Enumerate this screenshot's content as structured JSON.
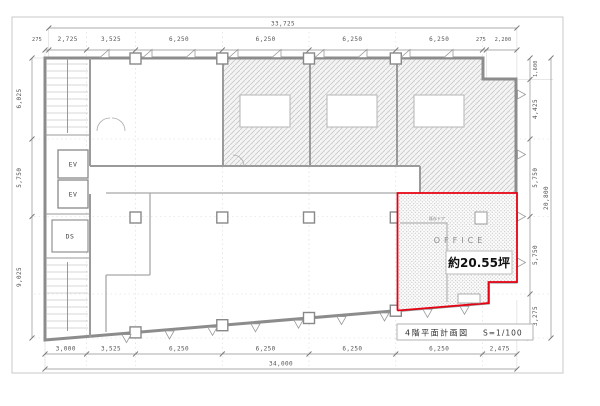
{
  "drawing": {
    "title_block": {
      "title": "4階平面計画図",
      "scale": "S=1/100"
    },
    "highlight": {
      "room_label": "OFFICE",
      "area_label": "約20.55坪",
      "door_note": "既存ドア",
      "outline_color": "#e60012"
    },
    "core": {
      "ev1": "EV",
      "ev2": "EV",
      "ds": "DS"
    },
    "dimensions": {
      "top_total": "33,725",
      "top": [
        "275",
        "2,725",
        "3,525",
        "6,250",
        "6,250",
        "6,250",
        "6,250",
        "275",
        "2,200"
      ],
      "left": [
        "6,025",
        "5,750",
        "9,025"
      ],
      "right": [
        "1,600",
        "4,425",
        "5,750",
        "5,750",
        "3,275"
      ],
      "right_total": "20,800",
      "bottom": [
        "3,000",
        "3,525",
        "6,250",
        "6,250",
        "6,250",
        "6,250",
        "2,475"
      ],
      "bottom_total": "34,000"
    }
  }
}
